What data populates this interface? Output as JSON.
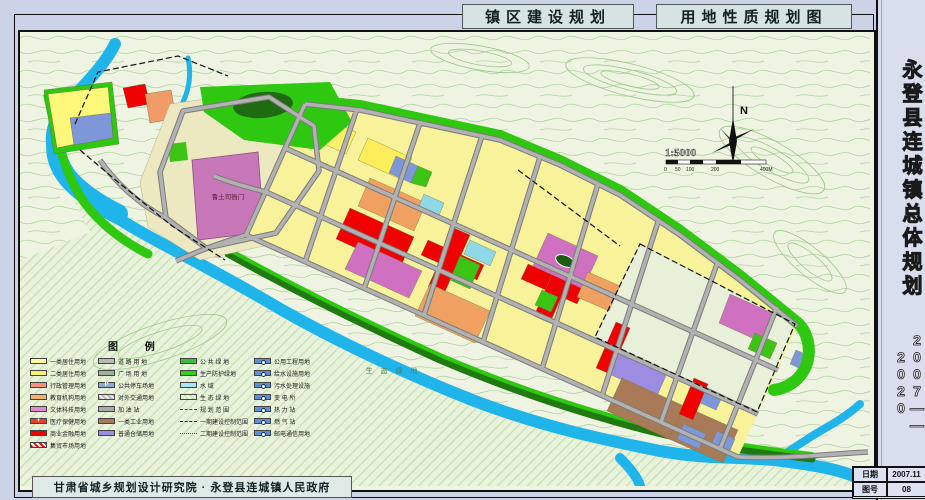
{
  "header": {
    "title_left": "镇区建设规划",
    "title_right": "用地性质规划图"
  },
  "sidebar": {
    "title_vertical": "永登县连城镇总体规划",
    "years_vertical": "2007——2020",
    "info": {
      "date_label": "日期",
      "date_value": "2007.11",
      "sheet_label": "图号",
      "sheet_value": "08"
    }
  },
  "footer": {
    "credit": "甘肃省城乡规划设计研究院 · 永登县连城镇人民政府"
  },
  "map": {
    "compass_label": "N",
    "scale_text": "1:5000",
    "scale_ticks": [
      "0",
      "50",
      "100",
      "200",
      "400M"
    ],
    "labels": {
      "historic_site": "鲁土司衙门",
      "eco_green": "生 态 绿 地"
    }
  },
  "colors": {
    "residential_1": "#fdfba8",
    "residential_2": "#fbf06a",
    "administration": "#f2917c",
    "education": "#f5af67",
    "culture": "#e189cb",
    "commercial": "#f50000",
    "industry": "#a97a58",
    "warehouse": "#9c8de2",
    "road": "#b9b9b9",
    "public_green": "#3dbb3d",
    "protective_green": "#2ed311",
    "water": "#1fb4ea",
    "utility_blue": "#5e8fd6"
  },
  "legend": {
    "title": "图  例",
    "columns": [
      [
        {
          "label": "一类居住用地",
          "type": "solid",
          "color": "#fdfba8"
        },
        {
          "label": "二类居住用地",
          "type": "solid",
          "color": "#fbf06a"
        },
        {
          "label": "行政管理用地",
          "type": "solid",
          "color": "#f2917c"
        },
        {
          "label": "教育机构用地",
          "type": "solid",
          "color": "#f5af67"
        },
        {
          "label": "文体科技用地",
          "type": "solid",
          "color": "#e189cb"
        },
        {
          "label": "医疗保健用地",
          "type": "solid",
          "color": "#ef4123",
          "glyph": "+"
        },
        {
          "label": "商业金融用地",
          "type": "solid",
          "color": "#f50000"
        },
        {
          "label": "集贸市场用地",
          "type": "hatch-red"
        }
      ],
      [
        {
          "label": "道 路 用 地",
          "type": "solid",
          "color": "#b9b9b9"
        },
        {
          "label": "广 场 用 地",
          "type": "solid",
          "color": "#9fb39b"
        },
        {
          "label": "公共停车场地",
          "type": "solid",
          "color": "#8da9cd",
          "glyph": "P"
        },
        {
          "label": "对外交通用地",
          "type": "hatch-gray"
        },
        {
          "label": "加  油  站",
          "type": "solid",
          "color": "#a9a9a9"
        },
        {
          "label": "一类工业用地",
          "type": "solid",
          "color": "#a97a58"
        },
        {
          "label": "普通仓储用地",
          "type": "solid",
          "color": "#9c8de2"
        }
      ],
      [
        {
          "label": "公 共 绿 地",
          "type": "solid",
          "color": "#3dbb3d"
        },
        {
          "label": "生产防护绿地",
          "type": "solid",
          "color": "#2ed311"
        },
        {
          "label": "水      域",
          "type": "solid",
          "color": "#a5e9f3"
        },
        {
          "label": "生 态 绿 地",
          "type": "hatch-green"
        },
        {
          "label": "规 划 范 围",
          "type": "dash-red"
        },
        {
          "label": "一期建设控制范围",
          "type": "dash-black"
        },
        {
          "label": "二期建设控制范围",
          "type": "dash-gray"
        }
      ],
      [
        {
          "label": "公用工程用地",
          "type": "solid",
          "color": "#5e8fd6",
          "icon": "circle"
        },
        {
          "label": "给水设施用地",
          "type": "solid",
          "color": "#5e8fd6",
          "icon": "circle"
        },
        {
          "label": "污水处理设施",
          "type": "solid",
          "color": "#5e8fd6",
          "icon": "circle"
        },
        {
          "label": "变  电  所",
          "type": "solid",
          "color": "#5e8fd6",
          "icon": "circle"
        },
        {
          "label": "热  力  站",
          "type": "solid",
          "color": "#5e8fd6",
          "icon": "circle"
        },
        {
          "label": "燃  气  站",
          "type": "solid",
          "color": "#5e8fd6",
          "icon": "circle"
        },
        {
          "label": "邮电通信用地",
          "type": "solid",
          "color": "#5e8fd6",
          "icon": "circle"
        }
      ]
    ]
  }
}
